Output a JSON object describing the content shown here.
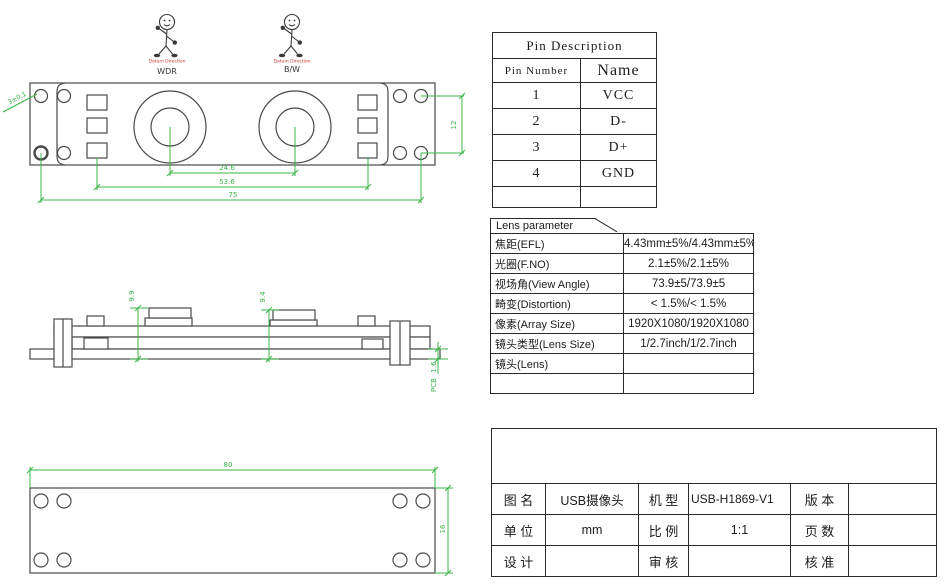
{
  "colors": {
    "drawing_line": "#4a4a4a",
    "dimension_green": "#3bb54a",
    "datum_red": "#cc3333",
    "table_border": "#2a2a2a"
  },
  "stick_figures": [
    {
      "datum_label": "Datum Direction",
      "caption": "WDR"
    },
    {
      "datum_label": "Datum Direction",
      "caption": "B/W"
    }
  ],
  "front_view": {
    "dim_lens_centers": "24.6",
    "dim_led_columns": "53.6",
    "dim_hole_span": "75",
    "dim_hole_rows": "12",
    "hole_leader_note": "3±0.1"
  },
  "side_view": {
    "dim_height_left": "9.9",
    "dim_height_right": "9.4",
    "dim_pcb_thickness": "1.6",
    "pcb_label": "PCB"
  },
  "back_view": {
    "dim_width": "80",
    "dim_height": "16"
  },
  "pin_table": {
    "title": "Pin Description",
    "col_number": "Pin Number",
    "col_name": "Name",
    "rows": [
      [
        "1",
        "VCC"
      ],
      [
        "2",
        "D-"
      ],
      [
        "3",
        "D+"
      ],
      [
        "4",
        "GND"
      ]
    ]
  },
  "lens_table": {
    "tab": "Lens parameter",
    "rows": [
      [
        "焦距(EFL)",
        "4.43mm±5%/4.43mm±5%"
      ],
      [
        "光圈(F.NO)",
        "2.1±5%/2.1±5%"
      ],
      [
        "视场角(View Angle)",
        "73.9±5/73.9±5"
      ],
      [
        "畸变(Distortion)",
        "< 1.5%/< 1.5%"
      ],
      [
        "像素(Array Size)",
        "1920X1080/1920X1080"
      ],
      [
        "镜头类型(Lens Size)",
        "1/2.7inch/1/2.7inch"
      ],
      [
        "镜头(Lens)",
        ""
      ],
      [
        "",
        ""
      ]
    ]
  },
  "title_block": {
    "rows": [
      [
        "图 名",
        "USB摄像头",
        "机 型",
        "USB-H1869-V1",
        "版 本",
        ""
      ],
      [
        "单 位",
        "mm",
        "比 例",
        "1:1",
        "页 数",
        ""
      ],
      [
        "设 计",
        "",
        "审 核",
        "",
        "核 准",
        ""
      ]
    ]
  }
}
